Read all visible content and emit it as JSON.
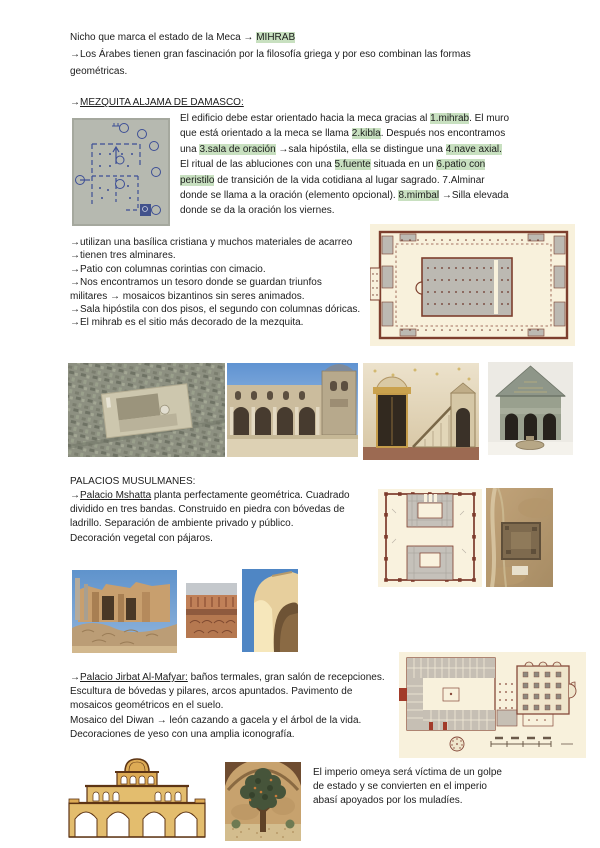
{
  "colors": {
    "highlight": "#c8e0c0",
    "plan_bg": "#f8f1dc",
    "plan_line": "#7d3f2e"
  },
  "intro": {
    "line1": [
      {
        "t": "Nicho que marca el estado de la Meca → "
      },
      {
        "t": "MIHRAB",
        "h": true
      }
    ],
    "line2": [
      {
        "t": "→Los Árabes tienen gran fascinación por la filosofía griega y por eso combinan las formas",
        "br": true
      },
      {
        "t": "geométricas."
      }
    ]
  },
  "damascus": {
    "heading": [
      {
        "t": "→"
      },
      {
        "t": "MEZQUITA ALJAMA DE DAMASCO:",
        "u": true
      }
    ],
    "paragraph": [
      {
        "t": "El edificio debe estar orientado hacia la meca gracias al "
      },
      {
        "t": "1.mihrab",
        "h": true
      },
      {
        "t": ". El muro",
        "br": true
      },
      {
        "t": "que está orientado a la meca se llama "
      },
      {
        "t": "2.kibla",
        "h": true
      },
      {
        "t": ". Después nos encontramos",
        "br": true
      },
      {
        "t": "una "
      },
      {
        "t": "3.sala de oración",
        "h": true
      },
      {
        "t": " →sala hipóstila, ella se distingue una "
      },
      {
        "t": "4.nave axial.",
        "h": true,
        "br": true
      },
      {
        "t": "El ritual de las abluciones con una "
      },
      {
        "t": "5.fuente",
        "h": true
      },
      {
        "t": " situada en un "
      },
      {
        "t": "6.patio con",
        "h": true,
        "br": true
      },
      {
        "t": "peristilo",
        "h": true
      },
      {
        "t": " de transición de la vida cotidiana al lugar sagrado. 7.Alminar",
        "br": true
      },
      {
        "t": "donde se llama a la oración (elemento opcional). "
      },
      {
        "t": "8.mimbal",
        "h": true
      },
      {
        "t": " →Silla elevada",
        "br": true
      },
      {
        "t": "donde se da la oración los viernes."
      }
    ],
    "bullets": [
      [
        {
          "t": "→utilizan una basílica cristiana y muchos materiales de acarreo"
        }
      ],
      [
        {
          "t": "→tienen tres alminares."
        }
      ],
      [
        {
          "t": "→Patio con columnas corintias con cimacio."
        }
      ],
      [
        {
          "t": "→Nos encontramos un tesoro donde se guardan triunfos",
          "br": true
        },
        {
          "t": "militares → mosaicos bizantinos sin seres animados."
        }
      ],
      [
        {
          "t": "→Sala hipóstila con dos pisos, el segundo con columnas dóricas."
        }
      ],
      [
        {
          "t": "→El mihrab es el sitio más decorado de la mezquita."
        }
      ]
    ]
  },
  "palaces": {
    "heading": "PALACIOS MUSULMANES:",
    "mshatta": [
      {
        "t": "→"
      },
      {
        "t": "Palacio Mshatta",
        "u": true
      },
      {
        "t": " planta perfectamente geométrica. Cuadrado",
        "br": true
      },
      {
        "t": "dividido en tres bandas. Construido en piedra con bóvedas de",
        "br": true
      },
      {
        "t": "ladrillo. Separación de ambiente privado y público.",
        "br": true
      },
      {
        "t": "Decoración vegetal con pájaros."
      }
    ],
    "jirbat": [
      {
        "t": "→"
      },
      {
        "t": "Palacio Jirbat Al-Mafyar:",
        "u": true
      },
      {
        "t": " baños termales, gran salón de recepciones.",
        "br": true
      },
      {
        "t": "Escultura de bóvedas y pilares, arcos apuntados. Pavimento de",
        "br": true
      },
      {
        "t": "mosaicos geométricos en el suelo.",
        "br": true
      },
      {
        "t": "Mosaico del Diwan → león cazando a gacela y el árbol de la vida.",
        "br": true
      },
      {
        "t": "Decoraciones de yeso con una amplia iconografía."
      }
    ],
    "closing": [
      {
        "t": " El imperio omeya será víctima de un golpe",
        "br": true
      },
      {
        "t": "de estado y se convierten en el imperio",
        "br": true
      },
      {
        "t": "abasí apoyados por los muladíes."
      }
    ]
  },
  "figures": [
    "hand-sketch-plan",
    "damascus-mosque-plan",
    "damascus-aerial-photo",
    "damascus-courtyard-photo",
    "damascus-minbar-photo",
    "damascus-facade-photo",
    "mshatta-plan",
    "mshatta-aerial-photo",
    "ruins-photo",
    "carving-photo",
    "arch-photo",
    "jirbat-plan",
    "facade-elevation-drawing",
    "tree-of-life-mosaic"
  ]
}
